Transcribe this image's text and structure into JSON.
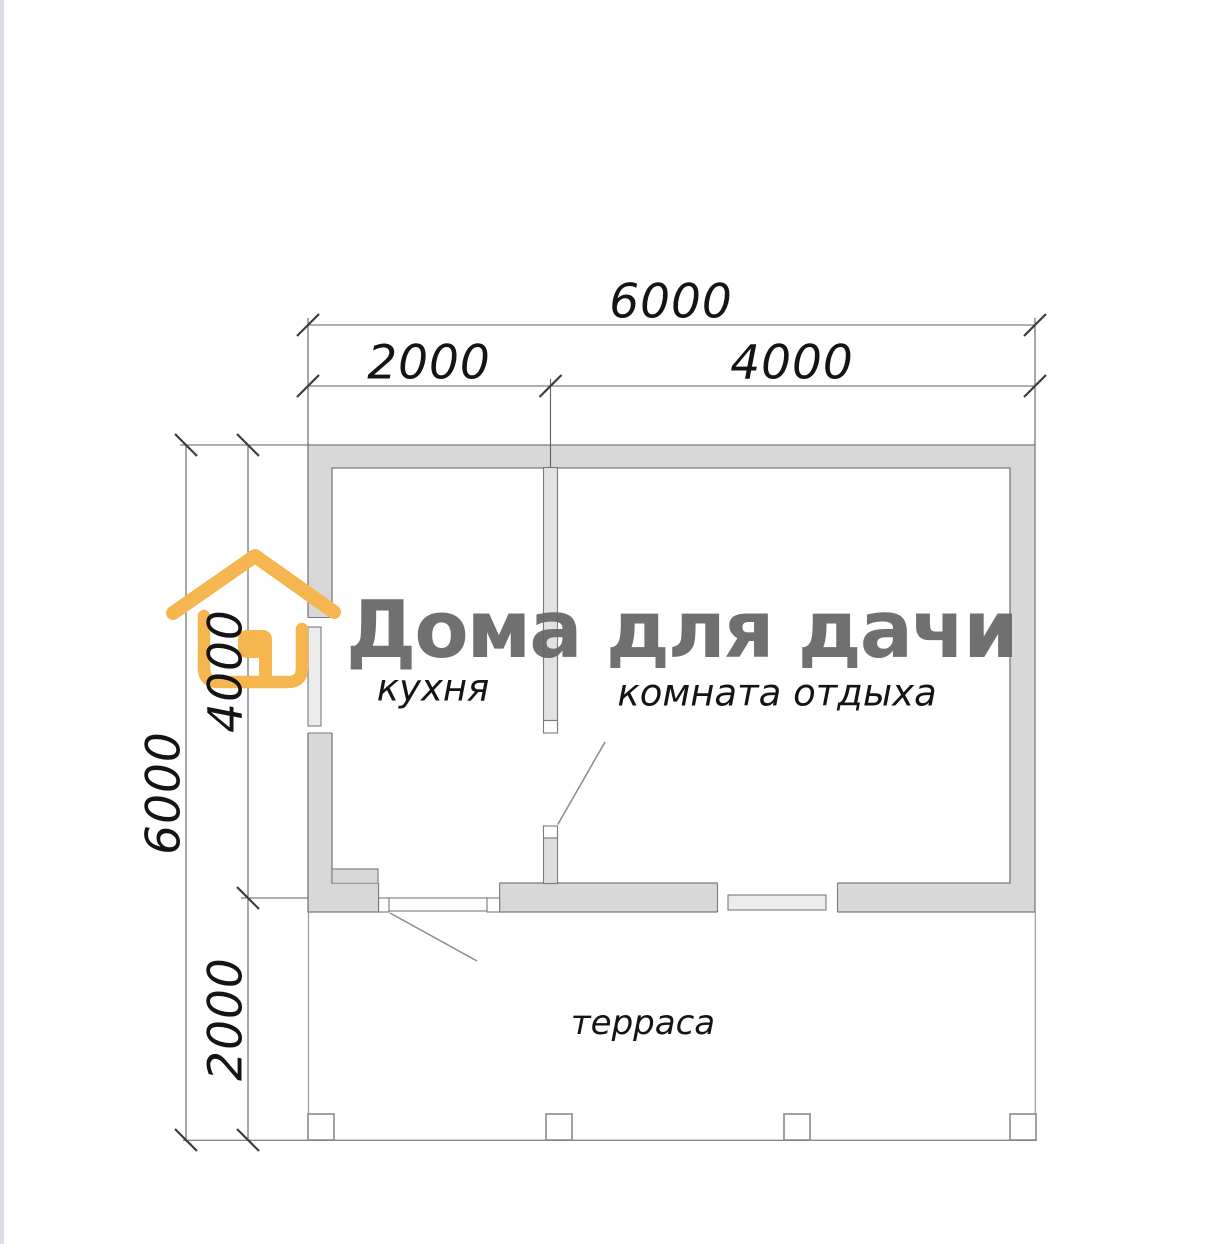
{
  "plan": {
    "title": "floor plan 6x6 with terrace",
    "dimensions": {
      "top_total": "6000",
      "top_left_segment": "2000",
      "top_right_segment": "4000",
      "left_total": "6000",
      "left_upper_segment": "4000",
      "left_lower_segment": "2000"
    },
    "rooms": {
      "kitchen": "кухня",
      "lounge": "комната отдыха",
      "terrace": "терраса"
    }
  },
  "watermark": {
    "brand": "Дома для дачи",
    "logo": "house-icon"
  },
  "colors": {
    "wall_fill": "#d8d8d8",
    "wall_stroke": "#7a7a7a",
    "dim_line": "#5f5f5f",
    "tick": "#3d3d3d",
    "accent_orange": "#f5b650",
    "watermark_gray": "#686868"
  }
}
